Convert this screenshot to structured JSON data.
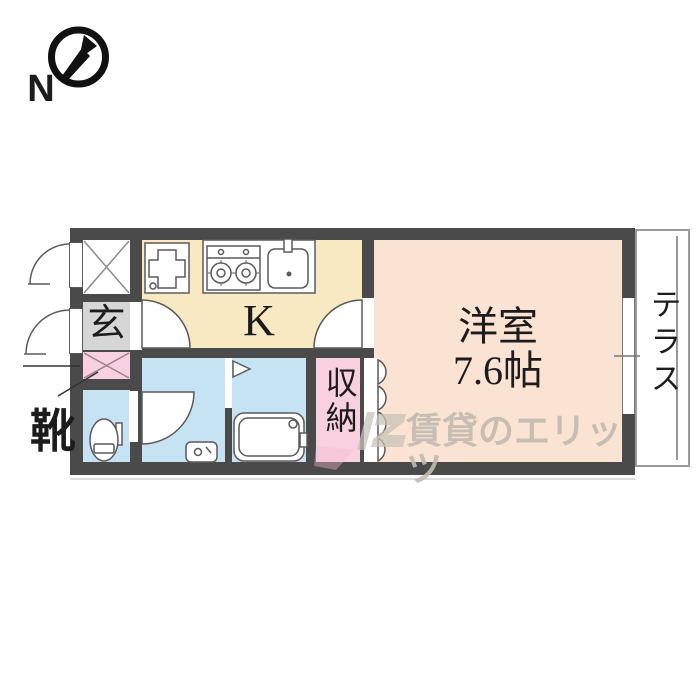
{
  "compass": {
    "label": "N"
  },
  "plan": {
    "entrance_label": "玄",
    "shoes_label": "靴",
    "kitchen_label": "K",
    "main_room_label": "洋室",
    "main_room_size": "7.6帖",
    "storage_label": "収納",
    "terrace_label": "テラス"
  },
  "watermark": {
    "text": "賃貸のエリッツ"
  },
  "colors": {
    "wall": "#4a4a4a",
    "kitchen": "#f8e9c2",
    "main_room": "#fbe3d4",
    "wet_area": "#c6e3f3",
    "closet": "#f8d0e0",
    "entrance": "#d6d6d6",
    "terrace_border": "#999999",
    "watermark": "#c2bbb0"
  }
}
